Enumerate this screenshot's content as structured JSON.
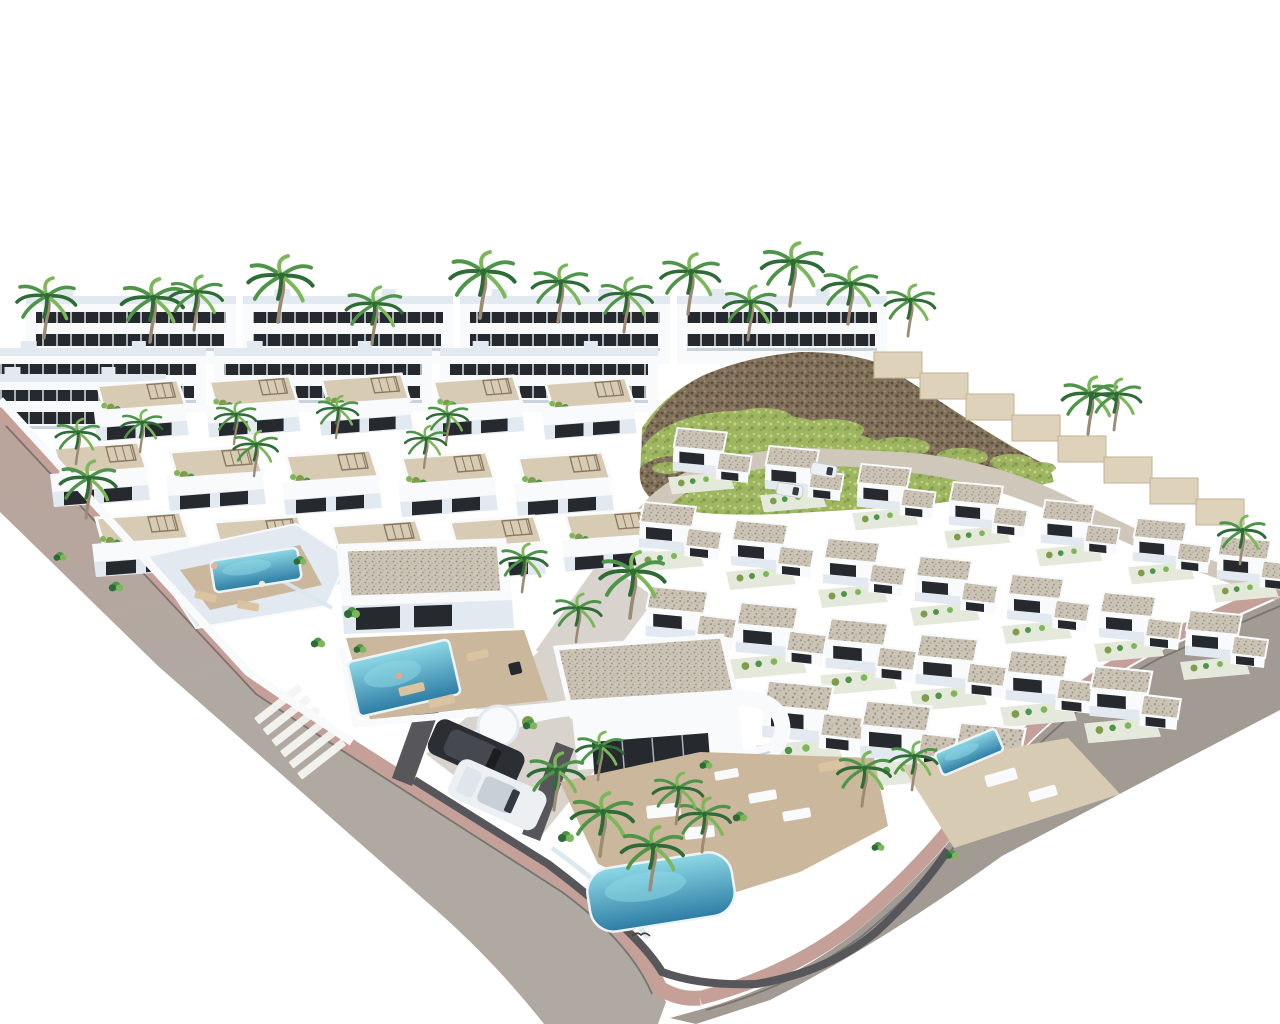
{
  "scene": {
    "description": "Aerial 3D architectural rendering of a white modern villa development: rows of flat-roofed villas with gravel roofs and rooftop terraces, turquoise pools, palm trees, a rocky hill with green scrub, apartment blocks behind, and gray roads with pink paved sidewalks and a zebra crosswalk"
  },
  "colors": {
    "background": "#ffffff",
    "building_white": "#f8fafc",
    "building_shade": "#e3e9f0",
    "building_shade_deep": "#c9d3de",
    "window_dark": "#26292e",
    "window_frame": "#aab4bd",
    "gravel_base": "#cbc3b5",
    "gravel_dot_dark": "#938a76",
    "gravel_dot_mid": "#b0a691",
    "terrace_light": "#d8cbb3",
    "terrace_warm": "#cbb79c",
    "road_gray": "#b0a9a2",
    "road_gray_dark": "#a29b94",
    "road_pink_tint": "#bba49b",
    "road_beige": "#cfc8ba",
    "sidewalk_pink": "#c5a099",
    "curb": "#7a7470",
    "concrete": "#d8d4cd",
    "pool_light": "#8ed9e6",
    "pool_deep": "#2d7ca4",
    "pool_edge": "#eef3f6",
    "palm_dark": "#2e6b36",
    "palm_mid": "#4f9549",
    "palm_light": "#7cb75a",
    "palm_trunk": "#9c8b72",
    "rock_base": "#82725c",
    "rock_dark": "#5a4d3b",
    "rock_light": "#9d8d74",
    "grass_base": "#9eb661",
    "grass_light": "#c2d47e",
    "grass_dark": "#7e9c4a",
    "garden_pale": "#e4e9db",
    "wall_dark": "#56565b",
    "glass_fence": "#d9e7ee",
    "car_dark_body": "#2b2e33",
    "car_dark_cabin": "#45494f",
    "car_white_body": "#edf0f3",
    "car_white_cabin": "#c7cfd7",
    "windshield": "#343a41",
    "step_wall": "#ded3ba",
    "step_wall_line": "#c0b293",
    "lounger_tan": "#d9c49f",
    "crosswalk_white": "#f4f4f1"
  },
  "apartment_rows": [
    {
      "x": 26,
      "y": 296,
      "blocks": 4,
      "bw": 210,
      "gap": 7,
      "h": 68
    },
    {
      "x": -12,
      "y": 348,
      "blocks": 3,
      "bw": 218,
      "gap": 8,
      "h": 64
    },
    {
      "x": -24,
      "y": 374,
      "blocks": 1,
      "bw": 190,
      "gap": 0,
      "h": 52
    }
  ],
  "hill": {
    "grass_patches": [
      [
        700,
        428,
        26,
        9
      ],
      [
        762,
        418,
        30,
        10
      ],
      [
        830,
        430,
        34,
        11
      ],
      [
        900,
        447,
        30,
        10
      ],
      [
        962,
        457,
        26,
        9
      ],
      [
        1012,
        462,
        22,
        8
      ],
      [
        692,
        452,
        20,
        7
      ],
      [
        746,
        450,
        26,
        8
      ],
      [
        812,
        456,
        30,
        9
      ],
      [
        882,
        468,
        26,
        8
      ],
      [
        942,
        476,
        22,
        7
      ],
      [
        668,
        468,
        16,
        6
      ],
      [
        1040,
        468,
        16,
        6
      ]
    ]
  },
  "steps": {
    "x": 874,
    "y": 352,
    "n": 8,
    "dx": 46,
    "dy": 21,
    "h": 26
  },
  "crosswalk": {
    "cx": 302,
    "cy": 734,
    "angle": -38,
    "stripes": 6,
    "w": 56,
    "h": 8,
    "gap": 6
  },
  "villas_left": [
    [
      88,
      378,
      0.95
    ],
    [
      200,
      374,
      0.95
    ],
    [
      312,
      372,
      0.95
    ],
    [
      424,
      374,
      0.95
    ],
    [
      536,
      376,
      0.95
    ],
    [
      44,
      440,
      1.0
    ],
    [
      160,
      444,
      1.0
    ],
    [
      276,
      448,
      1.0
    ],
    [
      392,
      450,
      1.0
    ],
    [
      508,
      450,
      1.0
    ],
    [
      86,
      510,
      1.0
    ],
    [
      204,
      514,
      1.0
    ],
    [
      322,
      518,
      1.0
    ],
    [
      440,
      514,
      1.0
    ],
    [
      556,
      508,
      0.95
    ]
  ],
  "villas_right": [
    [
      668,
      426,
      0.95
    ],
    [
      760,
      444,
      0.95
    ],
    [
      852,
      462,
      0.95
    ],
    [
      944,
      480,
      0.95
    ],
    [
      1036,
      498,
      0.95
    ],
    [
      1128,
      516,
      0.95
    ],
    [
      1212,
      534,
      0.95
    ],
    [
      634,
      500,
      1.0
    ],
    [
      726,
      518,
      1.0
    ],
    [
      818,
      536,
      1.0
    ],
    [
      910,
      554,
      1.0
    ],
    [
      1002,
      572,
      1.0
    ],
    [
      1094,
      590,
      1.0
    ],
    [
      1180,
      608,
      1.0
    ],
    [
      640,
      584,
      1.1
    ],
    [
      730,
      600,
      1.1
    ],
    [
      820,
      616,
      1.1
    ],
    [
      910,
      632,
      1.1
    ],
    [
      1000,
      648,
      1.1
    ],
    [
      1084,
      664,
      1.1
    ],
    [
      756,
      678,
      1.25
    ],
    [
      854,
      698,
      1.25
    ],
    [
      948,
      720,
      1.25
    ]
  ],
  "pools": [
    {
      "x": 212,
      "y": 554,
      "w": 88,
      "h": 32,
      "rx": 5,
      "angle": -9
    },
    {
      "x": 352,
      "y": 650,
      "w": 104,
      "h": 56,
      "rx": 5,
      "angle": -13
    },
    {
      "x": 588,
      "y": 860,
      "w": 146,
      "h": 64,
      "rx": 24,
      "angle": -9
    },
    {
      "x": 936,
      "y": 740,
      "w": 66,
      "h": 24,
      "rx": 4,
      "angle": -23
    }
  ],
  "furniture": [
    [
      398,
      688,
      26,
      9,
      -14,
      "tan"
    ],
    [
      428,
      700,
      26,
      9,
      -14,
      "tan"
    ],
    [
      466,
      654,
      22,
      8,
      -14,
      "tan"
    ],
    [
      748,
      794,
      28,
      10,
      -10,
      "white"
    ],
    [
      782,
      812,
      28,
      10,
      -10,
      "white"
    ],
    [
      714,
      772,
      24,
      9,
      -10,
      "white"
    ],
    [
      646,
      806,
      34,
      13,
      -6,
      "white"
    ],
    [
      684,
      828,
      30,
      12,
      -6,
      "white"
    ],
    [
      984,
      776,
      32,
      12,
      -16,
      "white"
    ],
    [
      1028,
      792,
      28,
      11,
      -16,
      "white"
    ],
    [
      196,
      590,
      22,
      8,
      14,
      "tan"
    ],
    [
      238,
      600,
      22,
      8,
      10,
      "tan"
    ],
    [
      818,
      764,
      26,
      9,
      -12,
      "tan"
    ],
    [
      508,
      664,
      12,
      12,
      -14,
      "dark"
    ]
  ],
  "cars": [
    {
      "kind": "suv-dark",
      "x": 440,
      "y": 716,
      "angle": 24
    },
    {
      "kind": "pickup-white",
      "x": 462,
      "y": 756,
      "angle": 24
    },
    {
      "kind": "car-white-small",
      "x": 778,
      "y": 482,
      "angle": 10
    },
    {
      "kind": "car-white-small",
      "x": 812,
      "y": 462,
      "angle": 10
    }
  ],
  "people": [
    [
      214,
      566,
      "#e9b29b"
    ],
    [
      262,
      584,
      "#f2e9df"
    ],
    [
      399,
      676,
      "#e8a58c"
    ],
    [
      704,
      800,
      "#d89a7e"
    ]
  ],
  "palms": [
    [
      44,
      338,
      1
    ],
    [
      150,
      342,
      1.05
    ],
    [
      194,
      330,
      0.9
    ],
    [
      278,
      322,
      1.1
    ],
    [
      372,
      344,
      0.95
    ],
    [
      480,
      318,
      1.1
    ],
    [
      558,
      322,
      0.95
    ],
    [
      624,
      332,
      0.9
    ],
    [
      688,
      314,
      1
    ],
    [
      748,
      340,
      0.9
    ],
    [
      790,
      306,
      1.05
    ],
    [
      848,
      324,
      0.95
    ],
    [
      908,
      336,
      0.85
    ],
    [
      1088,
      434,
      0.95
    ],
    [
      1114,
      430,
      0.85
    ],
    [
      76,
      464,
      0.75
    ],
    [
      140,
      452,
      0.7
    ],
    [
      234,
      444,
      0.7
    ],
    [
      336,
      438,
      0.7
    ],
    [
      446,
      444,
      0.7
    ],
    [
      86,
      518,
      0.95
    ],
    [
      254,
      476,
      0.75
    ],
    [
      424,
      468,
      0.7
    ],
    [
      522,
      592,
      0.8
    ],
    [
      630,
      618,
      1.1
    ],
    [
      576,
      642,
      0.8
    ],
    [
      554,
      810,
      0.95
    ],
    [
      600,
      856,
      1.05
    ],
    [
      650,
      890,
      1.05
    ],
    [
      702,
      852,
      0.9
    ],
    [
      598,
      780,
      0.8
    ],
    [
      862,
      806,
      0.9
    ],
    [
      912,
      790,
      0.8
    ],
    [
      676,
      824,
      0.85
    ],
    [
      1240,
      564,
      0.8
    ]
  ],
  "shrubs": [
    [
      352,
      612,
      1
    ],
    [
      318,
      642,
      0.9
    ],
    [
      360,
      648,
      0.8
    ],
    [
      566,
      836,
      1
    ],
    [
      740,
      816,
      0.9
    ],
    [
      878,
      846,
      0.8
    ],
    [
      300,
      560,
      0.8
    ],
    [
      706,
      764,
      0.8
    ],
    [
      530,
      724,
      0.9
    ],
    [
      952,
      854,
      0.8
    ],
    [
      116,
      586,
      0.9
    ],
    [
      60,
      556,
      0.8
    ]
  ],
  "bird": {
    "x": 632,
    "y": 936
  }
}
